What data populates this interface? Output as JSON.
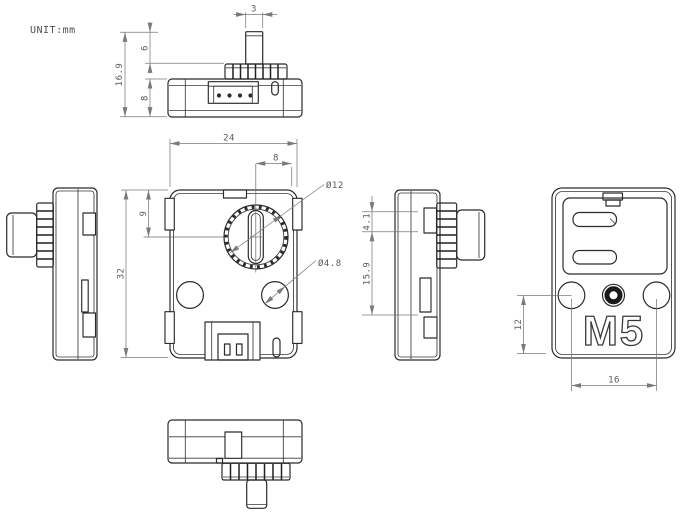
{
  "drawing": {
    "unit_label": "UNIT:mm",
    "logo_text": "M5",
    "colors": {
      "outline": "#2b2b2b",
      "dim_line": "#7a7a7a",
      "dim_text": "#5a5a5a",
      "background": "#ffffff"
    },
    "views": {
      "top_view": {
        "dim_shaft_width": "3",
        "dim_shaft_height": "6",
        "dim_body_thickness": "8",
        "dim_total_height": "16.9"
      },
      "front_view": {
        "dim_width": "24",
        "dim_knob_offset": "8",
        "dim_knob_top_offset": "9",
        "dim_height": "32",
        "dim_knob_diameter": "Ø12",
        "dim_hole_diameter": "Ø4.8"
      },
      "right_side_view": {
        "dim_shaft_offset": "4.1",
        "dim_center_height": "15.9"
      },
      "back_view": {
        "dim_hole_to_bottom": "12",
        "dim_hole_spacing": "16"
      }
    }
  }
}
